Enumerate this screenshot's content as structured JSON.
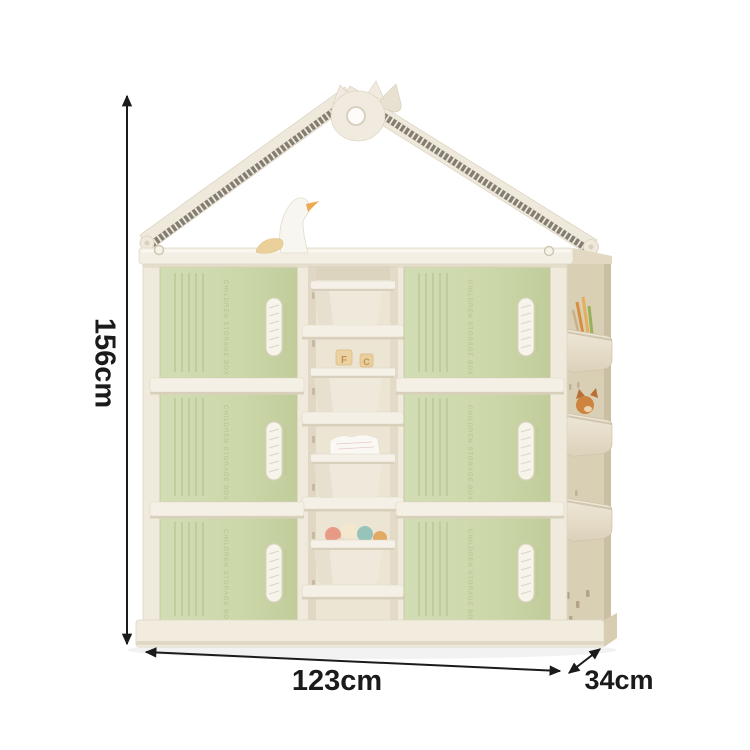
{
  "scene": {
    "type": "product-dimension-photo",
    "background_color": "#ffffff",
    "product": "kids house-shaped toy storage cabinet with bins"
  },
  "dimensions": {
    "height_label": "156cm",
    "width_label": "123cm",
    "depth_label": "34cm"
  },
  "cabinet": {
    "door_embossed_text": "CHILDREN STORAGE BOX",
    "door_rows": 3,
    "door_columns": 2,
    "block_letters": [
      "F",
      "C"
    ],
    "bins": [
      {
        "position": 1,
        "contents": "empty"
      },
      {
        "position": 2,
        "contents": "letter-blocks"
      },
      {
        "position": 3,
        "contents": "white-tissue"
      },
      {
        "position": 4,
        "contents": "toy-balls"
      }
    ],
    "side_pockets": [
      {
        "position": "top",
        "contents": "pencils"
      },
      {
        "position": "middle",
        "contents": "plush-fox"
      },
      {
        "position": "bottom",
        "contents": "empty"
      }
    ],
    "top_decor": "duck-figurine",
    "colors": {
      "frame_cream": "#f0eadd",
      "door_green": "#ccd7ab",
      "side_tan": "#d9cfb4",
      "bin_ivory": "#efe9db",
      "rail_white": "#f5f0e6",
      "roof_weave_dark": "#837d72",
      "dimension_black": "#1b1b1b"
    }
  }
}
